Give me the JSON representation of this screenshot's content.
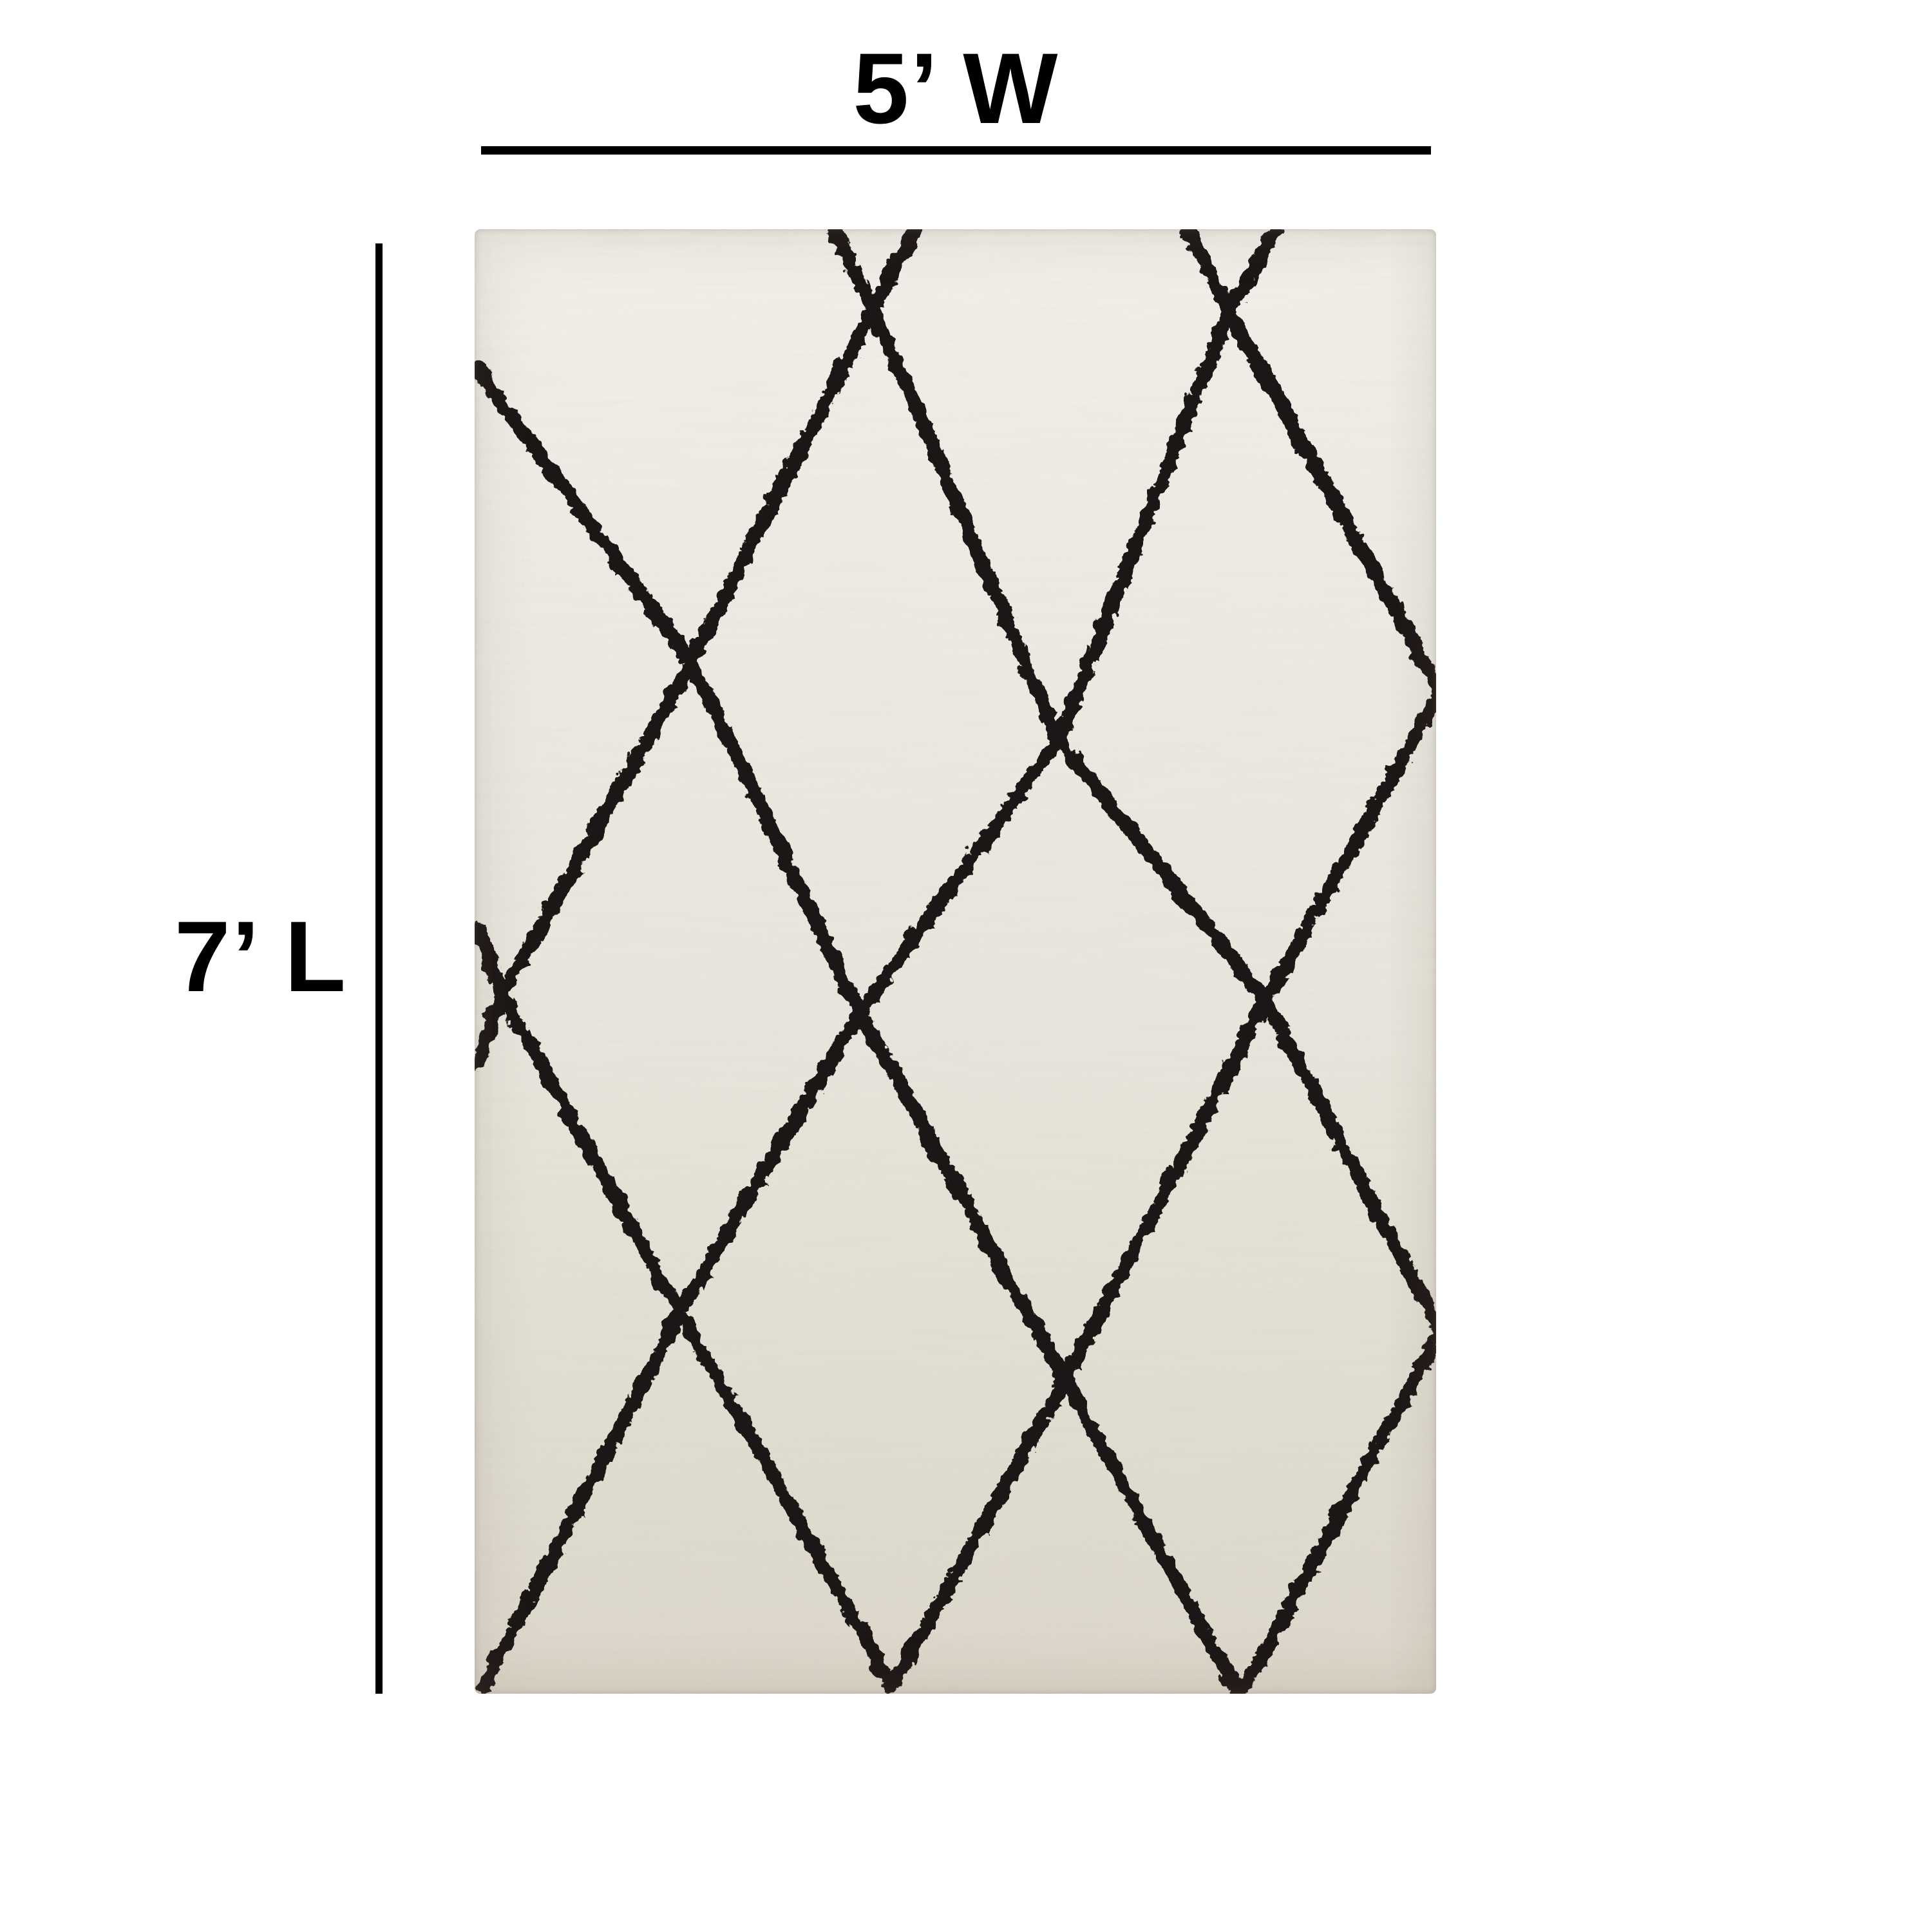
{
  "page": {
    "background_color": "#ffffff"
  },
  "diagram": {
    "type": "product-dimensions",
    "width_label": "5’ W",
    "length_label": "7’ L",
    "annotation_color": "#000000"
  },
  "rug": {
    "description": "Ivory shag area rug with hand-drawn black diamond trellis pattern",
    "colors": {
      "base_light": "#f1efe9",
      "base_mid": "#e8e5dc",
      "base_dark": "#dcd7ca",
      "pattern": "#1b1813",
      "speckle": "#6e6552"
    },
    "pattern": {
      "viewbox_width": 1493,
      "viewbox_height": 2274,
      "stroke_width": 22,
      "polylines": [
        [
          [
            555,
            0
          ],
          [
            615,
            120
          ],
          [
            903,
            790
          ],
          [
            1226,
            1194
          ],
          [
            1496,
            1709
          ]
        ],
        [
          [
            1105,
            0
          ],
          [
            1168,
            124
          ],
          [
            1496,
            714
          ]
        ],
        [
          [
            0,
            214
          ],
          [
            333,
            669
          ],
          [
            594,
            1213
          ],
          [
            913,
            1782
          ],
          [
            1185,
            2274
          ]
        ],
        [
          [
            0,
            1079
          ],
          [
            40,
            1184
          ],
          [
            315,
            1678
          ],
          [
            645,
            2259
          ]
        ],
        [
          [
            680,
            0
          ],
          [
            615,
            120
          ],
          [
            333,
            669
          ],
          [
            40,
            1184
          ],
          [
            0,
            1293
          ]
        ],
        [
          [
            1240,
            0
          ],
          [
            1168,
            124
          ],
          [
            903,
            790
          ],
          [
            594,
            1213
          ],
          [
            315,
            1678
          ],
          [
            8,
            2264
          ]
        ],
        [
          [
            1496,
            714
          ],
          [
            1226,
            1194
          ],
          [
            913,
            1782
          ],
          [
            645,
            2259
          ]
        ],
        [
          [
            1496,
            1709
          ],
          [
            1185,
            2274
          ]
        ]
      ]
    }
  }
}
